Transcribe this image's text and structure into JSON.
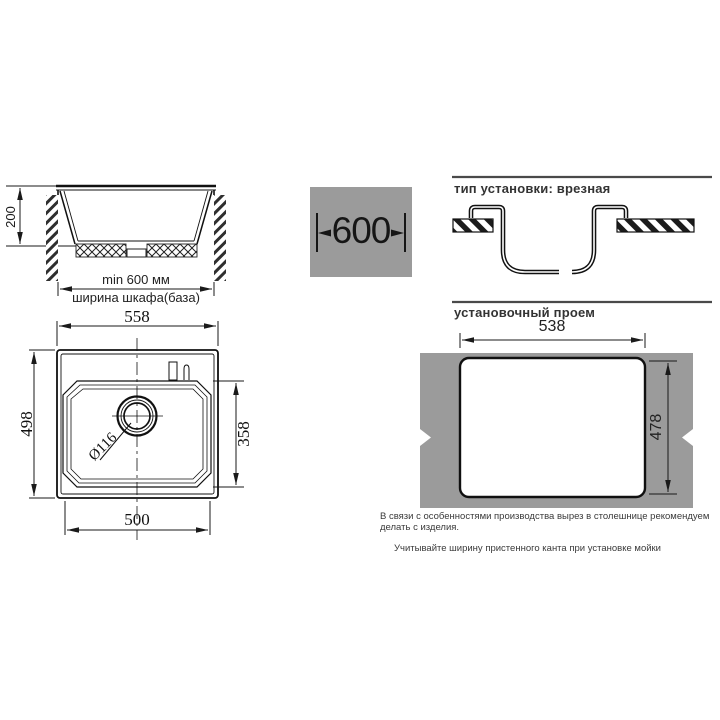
{
  "section_view": {
    "dim_height": "200",
    "dim_min_width": "min 600 мм",
    "dim_min_width_label": "ширина шкафа(база)"
  },
  "width_badge": {
    "value": "600"
  },
  "install_type": {
    "heading": "тип установки: врезная"
  },
  "opening": {
    "heading": "установочный проем",
    "dim_width": "538",
    "dim_height": "478",
    "note_production": "В связи с особенностями производства вырез в столешнице рекомендуем делать с изделия.",
    "note_edge": "Учитывайте ширину пристенного канта при установке мойки"
  },
  "top_view": {
    "dim_outer_width": "558",
    "dim_outer_height": "498",
    "dim_bowl_width": "500",
    "dim_bowl_height": "358",
    "dim_drain": "Ø116"
  },
  "colors": {
    "countertop_gray": "#9b9b9b",
    "line": "#1a1a1a",
    "separator": "#4a4a4a"
  }
}
